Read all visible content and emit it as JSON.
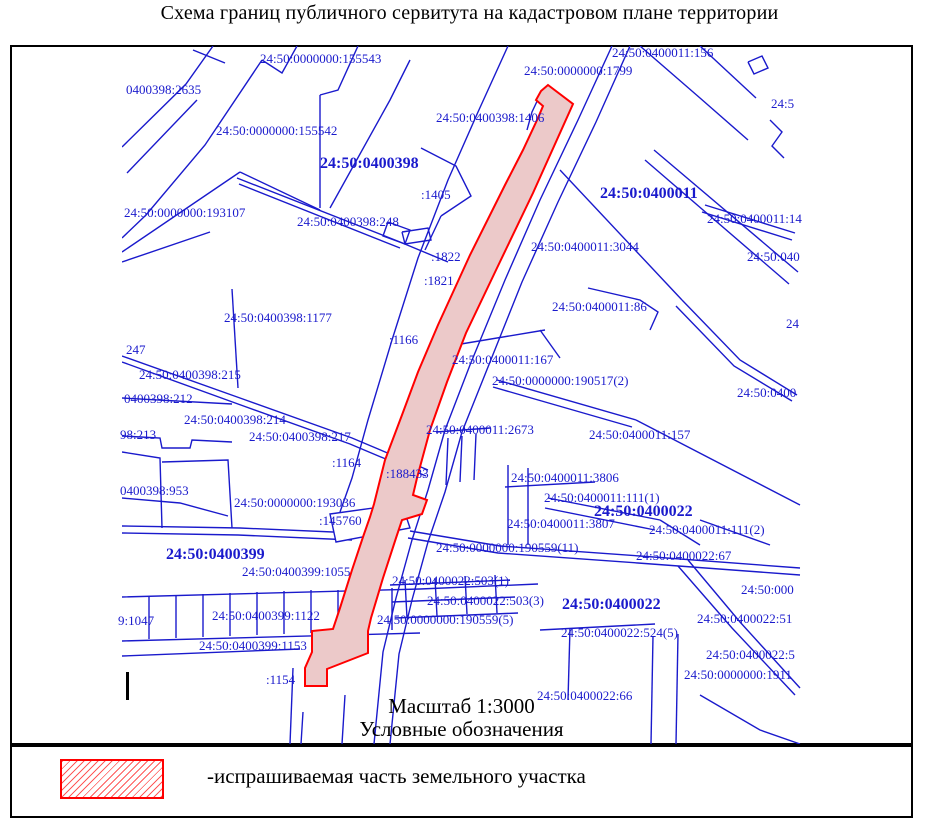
{
  "title": "Схема границ публичного сервитута на кадастровом плане территории",
  "map": {
    "scale_text": "Масштаб 1:3000",
    "legend_heading": "Условные обозначения",
    "region_labels": [
      {
        "text": "24:50:0000000:155543",
        "x": 260,
        "y": 52
      },
      {
        "text": "24:50:0400011:156",
        "x": 612,
        "y": 46
      },
      {
        "text": "24:50:0000000:1799",
        "x": 524,
        "y": 64
      },
      {
        "text": "0400398:2635",
        "x": 126,
        "y": 83
      },
      {
        "text": "24:5",
        "x": 771,
        "y": 97
      },
      {
        "text": "24:50:0400398:1406",
        "x": 436,
        "y": 111
      },
      {
        "text": "24:50:0000000:155542",
        "x": 216,
        "y": 124
      },
      {
        "text": "24:50:0400398",
        "x": 320,
        "y": 155,
        "bold": true
      },
      {
        "text": "24:50:0400011",
        "x": 600,
        "y": 185,
        "bold": true
      },
      {
        "text": ":1405",
        "x": 421,
        "y": 188
      },
      {
        "text": "24:50:0000000:193107",
        "x": 124,
        "y": 206
      },
      {
        "text": "24:50:0400398:248",
        "x": 297,
        "y": 215
      },
      {
        "text": "24:50:0400011:14",
        "x": 707,
        "y": 212
      },
      {
        "text": ":1822",
        "x": 431,
        "y": 250
      },
      {
        "text": ":1821",
        "x": 424,
        "y": 274
      },
      {
        "text": "24:50:0400011:3044",
        "x": 531,
        "y": 240
      },
      {
        "text": "24:50:040",
        "x": 747,
        "y": 250
      },
      {
        "text": "24",
        "x": 786,
        "y": 317
      },
      {
        "text": "24:50:0400011:86",
        "x": 552,
        "y": 300
      },
      {
        "text": "24:50:0400398:1177",
        "x": 224,
        "y": 311
      },
      {
        "text": ":1166",
        "x": 389,
        "y": 333
      },
      {
        "text": "247",
        "x": 126,
        "y": 343
      },
      {
        "text": "24:50:0400398:215",
        "x": 139,
        "y": 368
      },
      {
        "text": "0400398:212",
        "x": 124,
        "y": 392
      },
      {
        "text": "24:50:0400398:214",
        "x": 184,
        "y": 413
      },
      {
        "text": "98:213",
        "x": 120,
        "y": 428
      },
      {
        "text": "24:50:0400398:217",
        "x": 249,
        "y": 430
      },
      {
        "text": ":1164",
        "x": 332,
        "y": 456
      },
      {
        "text": ":188433",
        "x": 386,
        "y": 467
      },
      {
        "text": "24:50:0400011:167",
        "x": 452,
        "y": 353
      },
      {
        "text": "24:50:0000000:190517(2)",
        "x": 492,
        "y": 374
      },
      {
        "text": "24:50:0400011:2673",
        "x": 426,
        "y": 423
      },
      {
        "text": "24:50:0400011:157",
        "x": 589,
        "y": 428
      },
      {
        "text": "24:50:0400",
        "x": 737,
        "y": 386
      },
      {
        "text": "0400398:953",
        "x": 120,
        "y": 484
      },
      {
        "text": "24:50:0000000:193036",
        "x": 234,
        "y": 496
      },
      {
        "text": ":145760",
        "x": 319,
        "y": 514
      },
      {
        "text": "24:50:0400011:3806",
        "x": 511,
        "y": 471
      },
      {
        "text": "24:50:0400011:111(1)",
        "x": 544,
        "y": 491
      },
      {
        "text": "24:50:0400022",
        "x": 594,
        "y": 503,
        "bold": true
      },
      {
        "text": "24:50:0400011:3807",
        "x": 507,
        "y": 517
      },
      {
        "text": "24:50:0400011:111(2)",
        "x": 649,
        "y": 523
      },
      {
        "text": "24:50:0000000:190559(11)",
        "x": 436,
        "y": 541
      },
      {
        "text": "24:50:0400022:67",
        "x": 636,
        "y": 549
      },
      {
        "text": "24:50:0400399",
        "x": 166,
        "y": 546,
        "bold": true
      },
      {
        "text": "24:50:0400399:1055",
        "x": 242,
        "y": 565
      },
      {
        "text": "24:50:0400022:503(1)",
        "x": 392,
        "y": 574
      },
      {
        "text": "24:50:0400022:503(3)",
        "x": 427,
        "y": 594
      },
      {
        "text": "24:50:0000000:190559(5)",
        "x": 377,
        "y": 613
      },
      {
        "text": "24:50:0400022",
        "x": 562,
        "y": 596,
        "bold": true
      },
      {
        "text": "24:50:0400022:524(5)",
        "x": 561,
        "y": 626
      },
      {
        "text": "24:50:000",
        "x": 741,
        "y": 583
      },
      {
        "text": "24:50:0400022:51",
        "x": 697,
        "y": 612
      },
      {
        "text": "24:50:0400022:5",
        "x": 706,
        "y": 648
      },
      {
        "text": "24:50:0000000:1911",
        "x": 684,
        "y": 668
      },
      {
        "text": "24:50:0400022:66",
        "x": 537,
        "y": 689
      },
      {
        "text": "24:50:0400399:1122",
        "x": 212,
        "y": 609
      },
      {
        "text": "9:1047",
        "x": 118,
        "y": 614
      },
      {
        "text": "24:50:0400399:1153",
        "x": 199,
        "y": 639
      },
      {
        "text": ":1154",
        "x": 266,
        "y": 673
      }
    ]
  },
  "legend": {
    "items": [
      {
        "swatch": "red-hatch-rectangle",
        "label": "-испрашиваемая часть земельного участка"
      }
    ]
  },
  "colors": {
    "parcel_blue": "#1a1acc",
    "servitude_red": "#ff0000",
    "servitude_fill": "#ecc9c9",
    "ink_black": "#000000"
  }
}
